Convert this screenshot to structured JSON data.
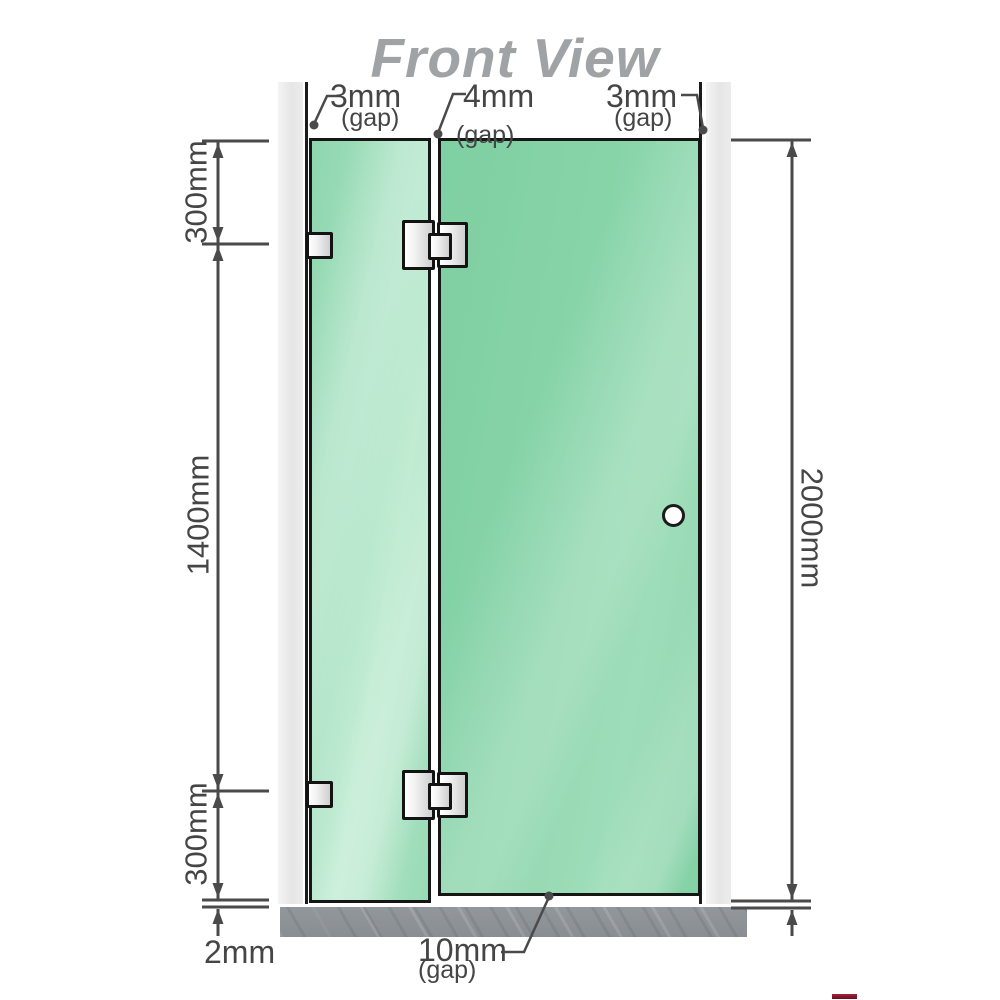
{
  "title": "Front View",
  "labels": {
    "gap_top_left": {
      "value": "3mm",
      "suffix": "(gap)"
    },
    "gap_top_center": {
      "value": "4mm",
      "suffix": "(gap)"
    },
    "gap_top_right": {
      "value": "3mm",
      "suffix": "(gap)"
    },
    "gap_bottom": {
      "value": "10mm",
      "suffix": "(gap)"
    },
    "segment_top": "300mm",
    "segment_middle": "1400mm",
    "segment_bottom": "300mm",
    "floor_gap": "2mm",
    "total_height": "2000mm"
  },
  "colors": {
    "glass_fixed_panel": "#a6e1c1",
    "glass_door_panel": "#86d2a7",
    "wall_channel": "#eaeaea",
    "floor_base": "#8d9296",
    "dimension_lines": "#4a4a4a",
    "title_text": "#a0a3a5",
    "hardware_border": "#131313",
    "corner_accent_red": "#8d1a2c"
  }
}
